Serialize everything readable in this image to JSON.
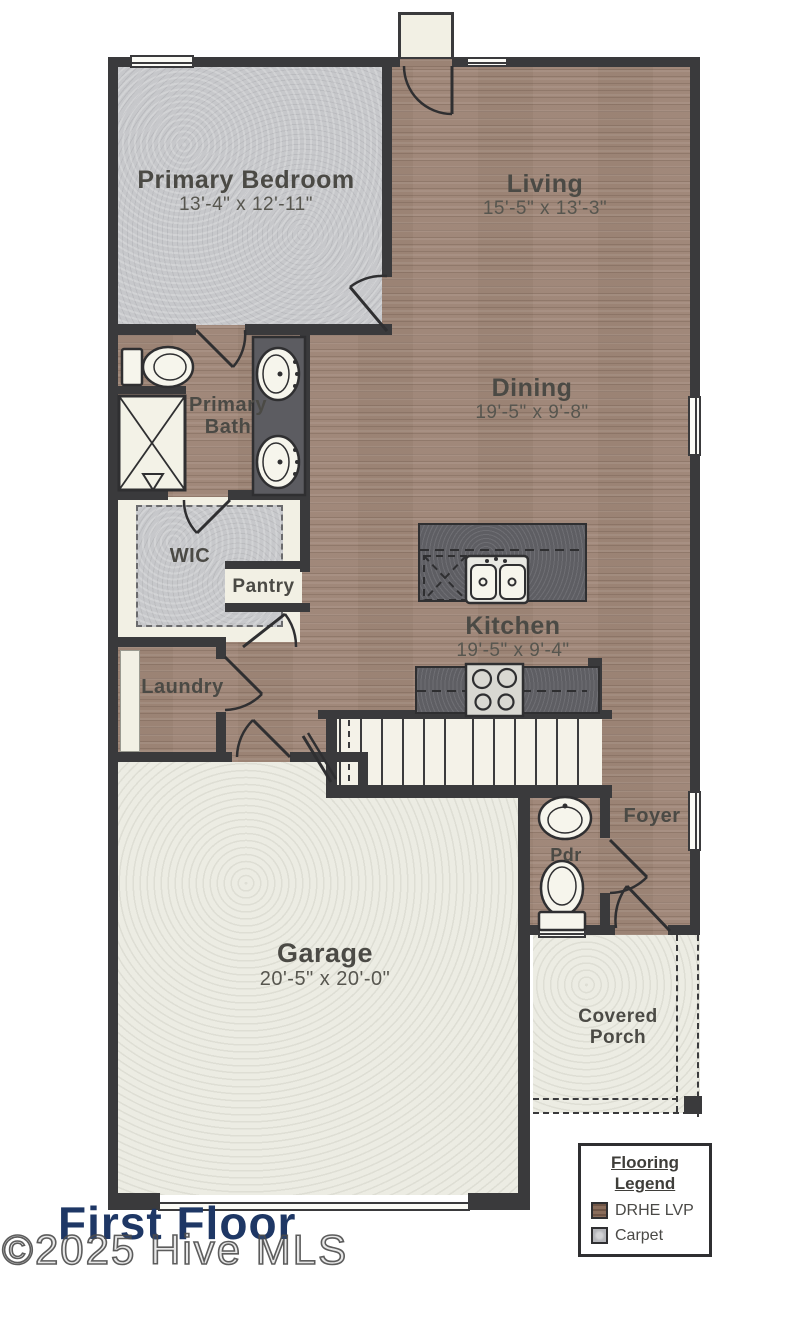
{
  "plan": {
    "floor_title": "First Floor",
    "watermark": "©2025 Hive MLS"
  },
  "rooms": {
    "primary_bedroom": {
      "name": "Primary Bedroom",
      "dims": "13'-4\" x 12'-11\""
    },
    "living": {
      "name": "Living",
      "dims": "15'-5\" x 13'-3\""
    },
    "dining": {
      "name": "Dining",
      "dims": "19'-5\" x 9'-8\""
    },
    "primary_bath": {
      "name_line1": "Primary",
      "name_line2": "Bath"
    },
    "wic": {
      "name": "WIC"
    },
    "pantry": {
      "name": "Pantry"
    },
    "laundry": {
      "name": "Laundry"
    },
    "kitchen": {
      "name": "Kitchen",
      "dims": "19'-5\" x 9'-4\""
    },
    "foyer": {
      "name": "Foyer"
    },
    "powder_room": {
      "name": "Pdr"
    },
    "garage": {
      "name": "Garage",
      "dims": "20'-5\" x 20'-0\""
    },
    "covered_porch": {
      "name_line1": "Covered",
      "name_line2": "Porch"
    }
  },
  "legend": {
    "title_line1": "Flooring",
    "title_line2": "Legend",
    "items": [
      {
        "label": "DRHE LVP",
        "swatch_color": "#8a6d5b"
      },
      {
        "label": "Carpet",
        "swatch_color": "#b4b5b9"
      }
    ]
  },
  "colors": {
    "lvp_floor": "#a28a7c",
    "carpet_floor": "#c7c8cb",
    "wall": "#3a3a3c",
    "counter_granite": "#5e5e63",
    "fixture_cream": "#f2f0e4",
    "garage_floor": "#ecece3",
    "title_navy": "#1e3765"
  }
}
